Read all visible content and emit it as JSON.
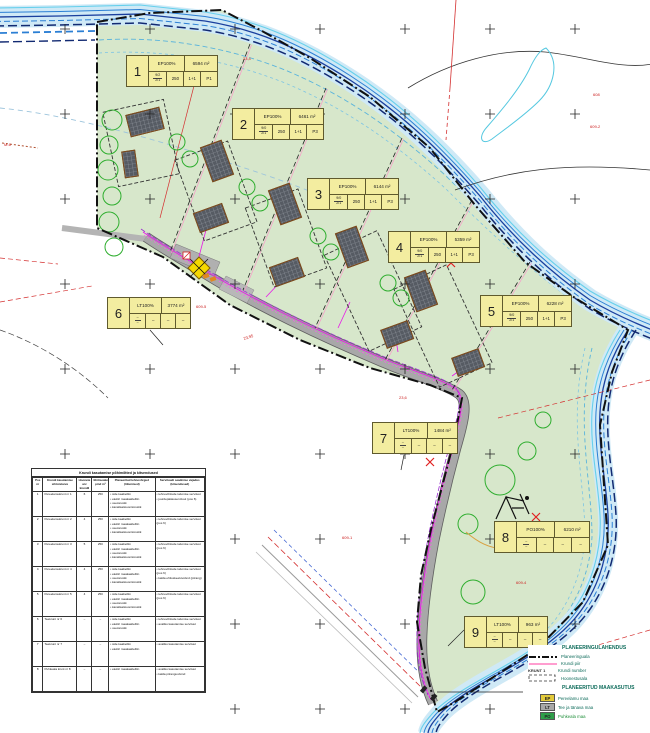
{
  "plots": [
    {
      "nr": "1",
      "use": "EP100%",
      "area": "6594 m²",
      "ft": "9/2",
      "fb": "2/1",
      "c1": "250",
      "c2": "1+1",
      "c3": "P1",
      "x": 126,
      "y": 55,
      "w": 92
    },
    {
      "nr": "2",
      "use": "EP100%",
      "area": "6461 m²",
      "ft": "9/0",
      "fb": "2/1",
      "c1": "250",
      "c2": "1+1",
      "c3": "P3",
      "x": 232,
      "y": 108,
      "w": 92
    },
    {
      "nr": "3",
      "use": "EP100%",
      "area": "6144 m²",
      "ft": "9/0",
      "fb": "2/1",
      "c1": "250",
      "c2": "1+1",
      "c3": "P3",
      "x": 307,
      "y": 178,
      "w": 92
    },
    {
      "nr": "4",
      "use": "EP100%",
      "area": "5359 m²",
      "ft": "9/0",
      "fb": "2/1",
      "c1": "250",
      "c2": "1+1",
      "c3": "P3",
      "x": 388,
      "y": 231,
      "w": 92
    },
    {
      "nr": "5",
      "use": "EP100%",
      "area": "6228 m²",
      "ft": "9/0",
      "fb": "2/1",
      "c1": "250",
      "c2": "1+1",
      "c3": "P3",
      "x": 480,
      "y": 295,
      "w": 92
    },
    {
      "nr": "6",
      "use": "LT100%",
      "area": "3774 m²",
      "ft": "–",
      "fb": "–",
      "c1": "–",
      "c2": "–",
      "c3": "–",
      "x": 107,
      "y": 297,
      "w": 84
    },
    {
      "nr": "7",
      "use": "LT100%",
      "area": "1484 m²",
      "ft": "–",
      "fb": "–",
      "c1": "–",
      "c2": "–",
      "c3": "–",
      "x": 372,
      "y": 422,
      "w": 86
    },
    {
      "nr": "8",
      "use": "PO100%",
      "area": "6210 m²",
      "ft": "–",
      "fb": "–",
      "c1": "–",
      "c2": "–",
      "c3": "–",
      "x": 494,
      "y": 521,
      "w": 96
    },
    {
      "nr": "9",
      "use": "LT100%",
      "area": "963 m²",
      "ft": "–",
      "fb": "–",
      "c1": "–",
      "c2": "–",
      "c3": "–",
      "x": 464,
      "y": 616,
      "w": 84
    }
  ],
  "legend": {
    "heading1": "PLANEERINGULAHENDUS",
    "items1": [
      "Planeeringuala",
      "Krundi piir",
      "Krundi number",
      "Hoonestusala"
    ],
    "krunt_sample": "KRUNT 1",
    "heading2": "PLANEERITUD MAAKASUTUS",
    "land_use": [
      {
        "code": "EP",
        "label": "Pereelamu maa",
        "color": "#e2ca3a",
        "label_color": "#0d6b5a"
      },
      {
        "code": "LT",
        "label": "Tee ja tänava maa",
        "color": "#a8a8a8",
        "label_color": "#0d6b5a"
      },
      {
        "code": "PO",
        "label": "Puhkeala maa",
        "color": "#2f9e49",
        "label_color": "#1f8f3a"
      }
    ]
  },
  "table": {
    "title": "Krundi kasutamise põhimõtted ja kitsendused",
    "headers": [
      "Pos nr",
      "Krundi kasutamise sihtotstarve",
      "Hoonete arv krundil",
      "Ehitisealune pind m²",
      "Planeeritud tehnovõrgud (liitumised)",
      "Servituudi seadmise vajadus (kitsendused)"
    ],
    "rows": [
      {
        "nr": "1",
        "name": "Pereelamukrunt nr 1",
        "size": "6",
        "bld": "250",
        "utils": [
          "side kaabelliin",
          "elektri maakaabelliin",
          "veetorustik",
          "kanalisatsioonitorustik"
        ],
        "serv": [
          "tehnovõrkude talumise servituut",
          "juurdepääsuservituut (pos 6)"
        ]
      },
      {
        "nr": "2",
        "name": "Pereelamukrunt nr 2",
        "size": "4",
        "bld": "250",
        "utils": [
          "side kaabelliin",
          "elektri maakaabelliin",
          "veetorustik",
          "kanalisatsioonitorustik"
        ],
        "serv": [
          "tehnovõrkude talumise servituut (pos 6)"
        ]
      },
      {
        "nr": "3",
        "name": "Pereelamukrunt nr 3",
        "size": "5",
        "bld": "250",
        "utils": [
          "side kaabelliin",
          "elektri maakaabelliin",
          "veetorustik",
          "kanalisatsioonitorustik"
        ],
        "serv": [
          "tehnovõrkude talumise servituut (pos 6)"
        ]
      },
      {
        "nr": "4",
        "name": "Pereelamukrunt nr 4",
        "size": "4",
        "bld": "250",
        "utils": [
          "side kaabelliin",
          "elektri maakaabelliin",
          "veetorustik",
          "kanalisatsioonitorustik"
        ],
        "serv": [
          "tehnovõrkude talumise servituut (pos 6)",
          "kalda ehituskeeluvöönd (piirang)"
        ]
      },
      {
        "nr": "5",
        "name": "Pereelamukrunt nr 5",
        "size": "4",
        "bld": "250",
        "utils": [
          "side kaabelliin",
          "elektri maakaabelliin",
          "veetorustik",
          "kanalisatsioonitorustik"
        ],
        "serv": [
          "tehnovõrkude talumise servituut (pos 6)"
        ]
      },
      {
        "nr": "6",
        "name": "Teekrunt nr 6",
        "size": "–",
        "bld": "–",
        "utils": [
          "side kaabelliin",
          "elektri maakaabelliin",
          "veetorustik"
        ],
        "serv": [
          "tehnovõrkude talumise servituut",
          "avaliku kasutamise servituut"
        ]
      },
      {
        "nr": "7",
        "name": "Teekrunt nr 7",
        "size": "–",
        "bld": "–",
        "utils": [
          "side kaabelliin",
          "elektri maakaabelliin"
        ],
        "serv": [
          "avaliku kasutamise servituut"
        ]
      },
      {
        "nr": "8",
        "name": "Puhkeala krunt nr 8",
        "size": "–",
        "bld": "–",
        "utils": [
          "elektri maakaabelliin"
        ],
        "serv": [
          "avaliku kasutamise servituut",
          "kalda piiranguvöönd"
        ]
      }
    ]
  },
  "annotations": [
    {
      "text": "608",
      "x": 593,
      "y": 96
    },
    {
      "text": "609-2",
      "x": 590,
      "y": 128
    },
    {
      "text": "23,4",
      "x": 243,
      "y": 60
    },
    {
      "text": "M-6",
      "x": 4,
      "y": 146
    },
    {
      "text": "23,95",
      "x": 244,
      "y": 340,
      "rot": -18
    },
    {
      "text": "609-5",
      "x": 196,
      "y": 308
    },
    {
      "text": "23,6",
      "x": 399,
      "y": 399
    },
    {
      "text": "609-1",
      "x": 342,
      "y": 539
    },
    {
      "text": "609-4",
      "x": 516,
      "y": 584
    }
  ],
  "colors": {
    "green_area": "#d7e7cb",
    "river_fill": "#cfe9f6",
    "river_dark": "#1a3f9e",
    "road": "#a8a8a8",
    "utility_magenta": "#e818e8",
    "boundary": "#111111",
    "plot_label_bg": "#f3eda0",
    "red_line": "#d43030"
  }
}
